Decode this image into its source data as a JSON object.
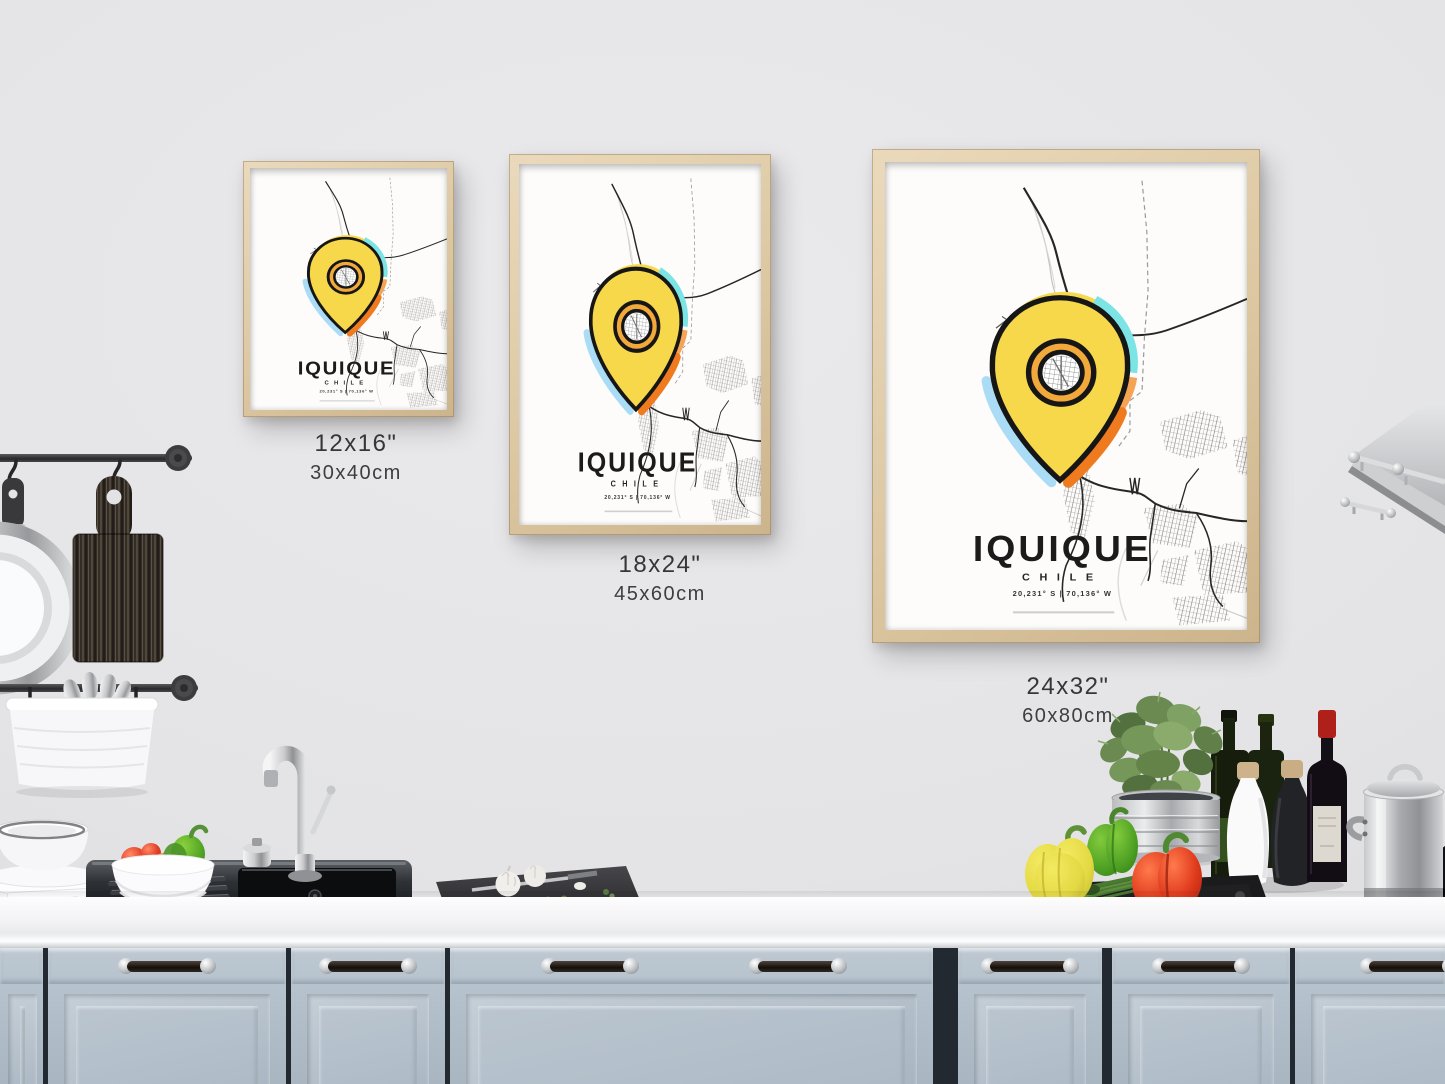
{
  "poster_design": {
    "title": "IQUIQUE",
    "subtitle": "CHILE",
    "coordinates": "20,231° S | 70,136° W",
    "pin_color": "#f8d84b",
    "accent_cyan": "#7de4e6",
    "accent_light_orange": "#f5a455",
    "accent_orange": "#ef7b1e",
    "accent_light_blue": "#abdcf6",
    "ring_color": "#f2a93b",
    "road_color": "#262626",
    "paper_color": "#fbfaf8",
    "frame_wood_color": "#dcc7a1"
  },
  "size_options": [
    {
      "inches": "12x16\"",
      "cm": "30x40cm"
    },
    {
      "inches": "18x24\"",
      "cm": "45x60cm"
    },
    {
      "inches": "24x32\"",
      "cm": "60x80cm"
    }
  ],
  "scene_colors": {
    "wall": "#e4e4e6",
    "cabinets": "#b2bfca",
    "countertop": "#f4f4f6"
  }
}
